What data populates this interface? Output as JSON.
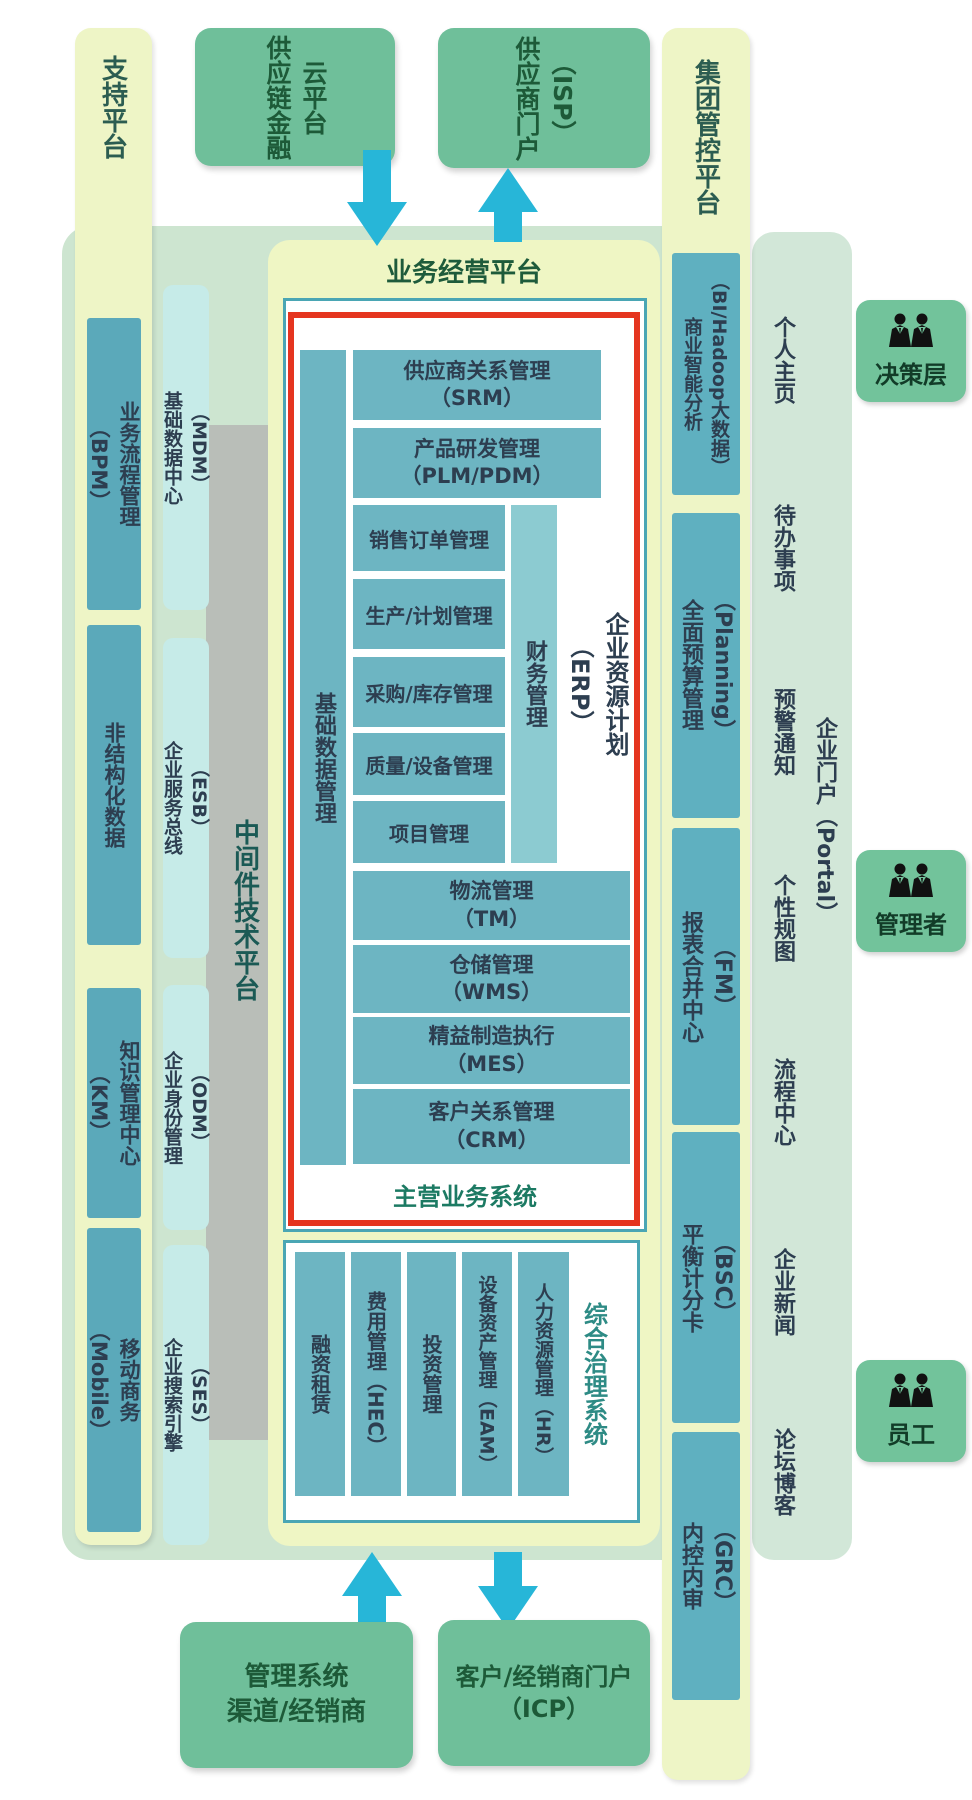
{
  "colors": {
    "pale_yellow": "#eef5c6",
    "light_green_backdrop": "#cde5d0",
    "medium_green": "#6fbf9a",
    "teal_box": "#6db5c2",
    "teal_sidebar": "#5ba9ba",
    "light_cyan": "#c6ebe8",
    "red_border": "#e5351f",
    "cyan_arrow": "#27b6d8",
    "gray_band": "#b9beb8"
  },
  "support": {
    "label": "支持平台",
    "boxes": [
      "业务流程管理\n（BPM）",
      "非结构化数据",
      "知识管理中心\n（KM）",
      "移动商务\n（Mobile）"
    ]
  },
  "services": {
    "columns": [
      "基础数据中心\n（MDM）",
      "企业服务总线\n（ESB）",
      "企业身份管理\n（ODM）",
      "企业搜索引擎\n（SES）"
    ],
    "middleware": "中间件技术平台"
  },
  "top": {
    "finance_cloud": "供应链金融\n云平台",
    "supplier_portal": "供应商门户\n（ISP）"
  },
  "business": {
    "title": "业务经营平台",
    "core": {
      "side": "基础数据管理",
      "srm": "供应商关系管理\n（SRM）",
      "plm": "产品研发管理\n（PLM/PDM）",
      "erp_rows": [
        "销售订单管理",
        "生产/计划管理",
        "采购/库存管理",
        "质量/设备管理",
        "项目管理"
      ],
      "finance": "财务管理",
      "erp_label": "企业资源计划\n（ERP）",
      "wide_rows": [
        "物流管理\n（TM）",
        "仓储管理\n（WMS）",
        "精益制造执行\n（MES）",
        "客户关系管理\n（CRM）"
      ],
      "footer": "主营业务系统"
    },
    "governance": {
      "columns": [
        "融资租赁",
        "费用管理（HEC）",
        "投资管理",
        "设备资产管理（EAM）",
        "人力资源管理（HR）"
      ],
      "label": "综合治理系统"
    }
  },
  "group": {
    "label": "集团管控平台",
    "boxes": [
      "商业智能分析\n（BI/Hadoop大数据）",
      "全面预算管理\n（Planning）",
      "报表合并中心\n（FM）",
      "平衡计分卡\n（BSC）",
      "内控内审\n（GRC）"
    ]
  },
  "portal": {
    "items": [
      "个人主页",
      "待办事项",
      "预警通知",
      "个性规图",
      "流程中心",
      "企业新闻",
      "论坛博客"
    ],
    "label": "企业门户（Portal）"
  },
  "roles": [
    "决策层",
    "管理者",
    "员工"
  ],
  "bottom": {
    "channel": "管理系统\n渠道/经销商",
    "customer_portal": "客户/经销商门户\n（ICP）"
  }
}
